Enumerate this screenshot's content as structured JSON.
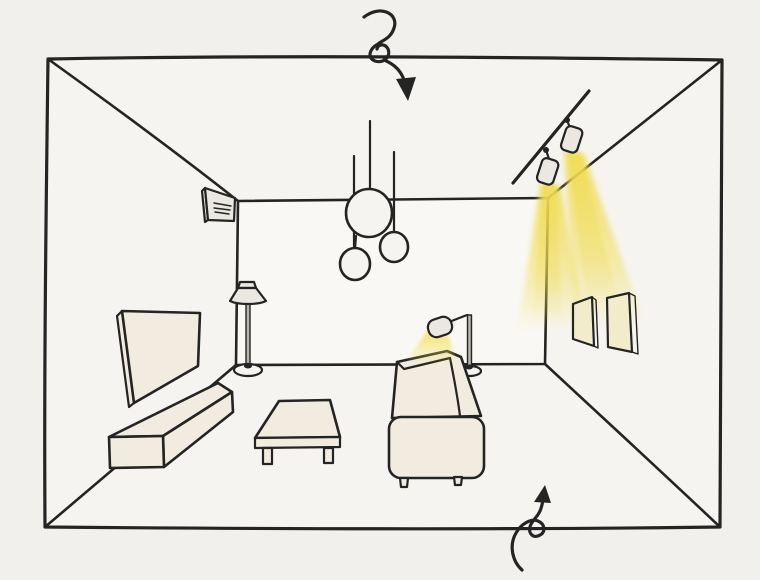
{
  "canvas": {
    "width": 760,
    "height": 580
  },
  "colors": {
    "paper": "#f2f0ec",
    "room": "#f6f4f0",
    "wall": "#f9f8f4",
    "ink": "#242424",
    "furniture": "#f1ecdf",
    "fixture": "#eae8e1",
    "metal": "#b8b4ac",
    "beam": "#f0dc4e",
    "glow": "#f5e14f",
    "frame": "#f3ecca"
  },
  "scene": {
    "items": {
      "room": {
        "label": "hand-drawn living room interior in one-point perspective"
      },
      "topArrow": {
        "label": "curled arrow pointing down at the ceiling lights"
      },
      "bottomArrow": {
        "label": "curled arrow pointing up at the floor lighting"
      },
      "ac": {
        "label": "air conditioner unit on left wall"
      },
      "pendants": {
        "label": "cluster of three globe pendant lights"
      },
      "track": {
        "label": "ceiling track with two spotlights casting yellow beams"
      },
      "art": {
        "label": "two picture frames lit on right wall"
      },
      "tv": {
        "label": "flat TV panel on left wall"
      },
      "console": {
        "label": "low media console below TV"
      },
      "floorLamp": {
        "label": "floor lamp with shade near back wall"
      },
      "table": {
        "label": "low coffee table"
      },
      "sofa": {
        "label": "sofa seen from behind"
      },
      "readingLamp": {
        "label": "arc reading lamp glowing over sofa"
      }
    }
  }
}
